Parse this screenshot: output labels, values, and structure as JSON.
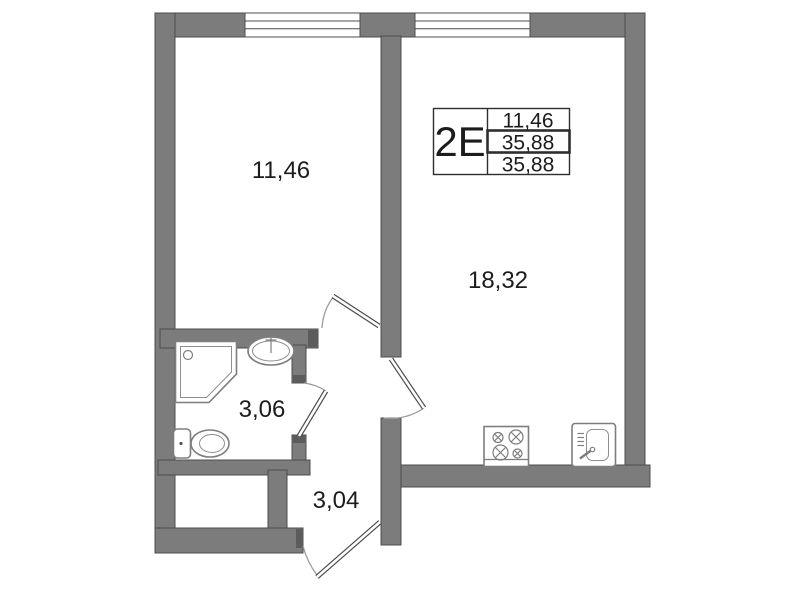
{
  "legend": {
    "type_label": "2Е",
    "values": [
      "11,46",
      "35,88",
      "35,88"
    ]
  },
  "rooms": [
    {
      "id": "room",
      "label": "11,46"
    },
    {
      "id": "living-kitchen",
      "label": "18,32"
    },
    {
      "id": "bathroom",
      "label": "3,06"
    },
    {
      "id": "hallway",
      "label": "3,04"
    }
  ],
  "windows": [
    {
      "name": "window-1",
      "wall": "top"
    },
    {
      "name": "window-2",
      "wall": "top"
    }
  ],
  "doors": [
    {
      "name": "room-door"
    },
    {
      "name": "living-room-door"
    },
    {
      "name": "bathroom-door"
    },
    {
      "name": "entrance-door"
    }
  ],
  "fixtures": [
    {
      "name": "shower-icon",
      "room": "bathroom"
    },
    {
      "name": "washbasin-icon",
      "room": "bathroom"
    },
    {
      "name": "toilet-icon",
      "room": "bathroom"
    },
    {
      "name": "stove-icon",
      "room": "living-kitchen"
    },
    {
      "name": "kitchen-sink-icon",
      "room": "living-kitchen"
    }
  ],
  "colors": {
    "wall": "#7c7c7c",
    "wall_outline": "#4c4c4c",
    "door_arc": "#9b9b9b",
    "fixture": "#7e7e7e",
    "legend_border": "#2e2e2e",
    "text": "#1c1c1c",
    "background": "#ffffff"
  }
}
